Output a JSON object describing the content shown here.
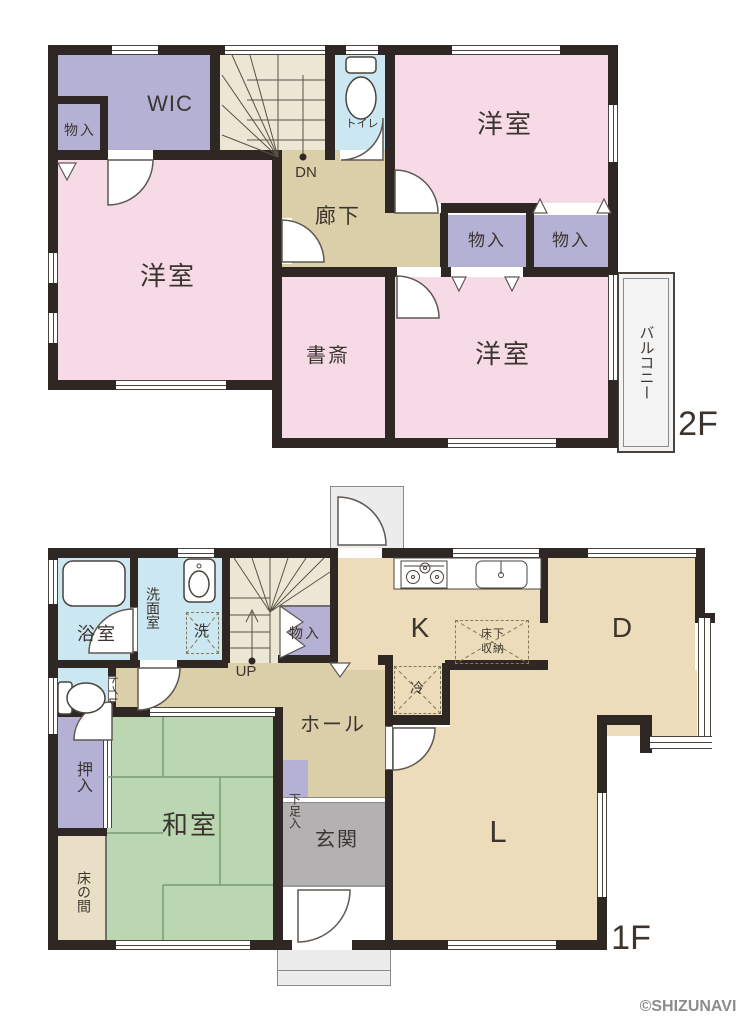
{
  "palette": {
    "wall": "#2e2723",
    "room-pink": "#f6dbe7",
    "closet-lavender": "#b5b1d4",
    "water-blue": "#cbe7f1",
    "corridor-tan": "#dbcfa9",
    "living-tan": "#ecdcba",
    "stairs-cream": "#ece7d4",
    "tatami-green": "#bad7b2",
    "tokonoma-tan": "#e9dfc6",
    "entrance-gray": "#b3b1b2",
    "outside-gray": "#ececec",
    "label-ink": "#3c352f",
    "credit-gray": "#8c8c8c"
  },
  "floor2": {
    "floor_label": "2F",
    "rooms": {
      "wic": "WIC",
      "closet_nw": "物入",
      "toilet": "トイレ",
      "bedroom_ne": "洋室",
      "corridor": "廊下",
      "stairs_down": "DN",
      "bedroom_w": "洋室",
      "closet_mid_left": "物入",
      "closet_mid_right": "物入",
      "study": "書斎",
      "bedroom_se": "洋室",
      "balcony": "バルコニー"
    }
  },
  "floor1": {
    "floor_label": "1F",
    "rooms": {
      "bath": "浴室",
      "washroom": "洗面室",
      "washer": "洗",
      "stairs_up": "UP",
      "closet_understairs": "物入",
      "toilet": "トイレ",
      "kitchen": "K",
      "underfloor_storage": "床下収納",
      "fridge": "冷",
      "dining": "D",
      "hall": "ホール",
      "shoe_cabinet": "下足入",
      "entrance": "玄関",
      "living": "L",
      "oshiire": "押入",
      "japanese_room": "和室",
      "tokonoma": "床の間"
    }
  },
  "credit": "©SHIZUNAVI"
}
